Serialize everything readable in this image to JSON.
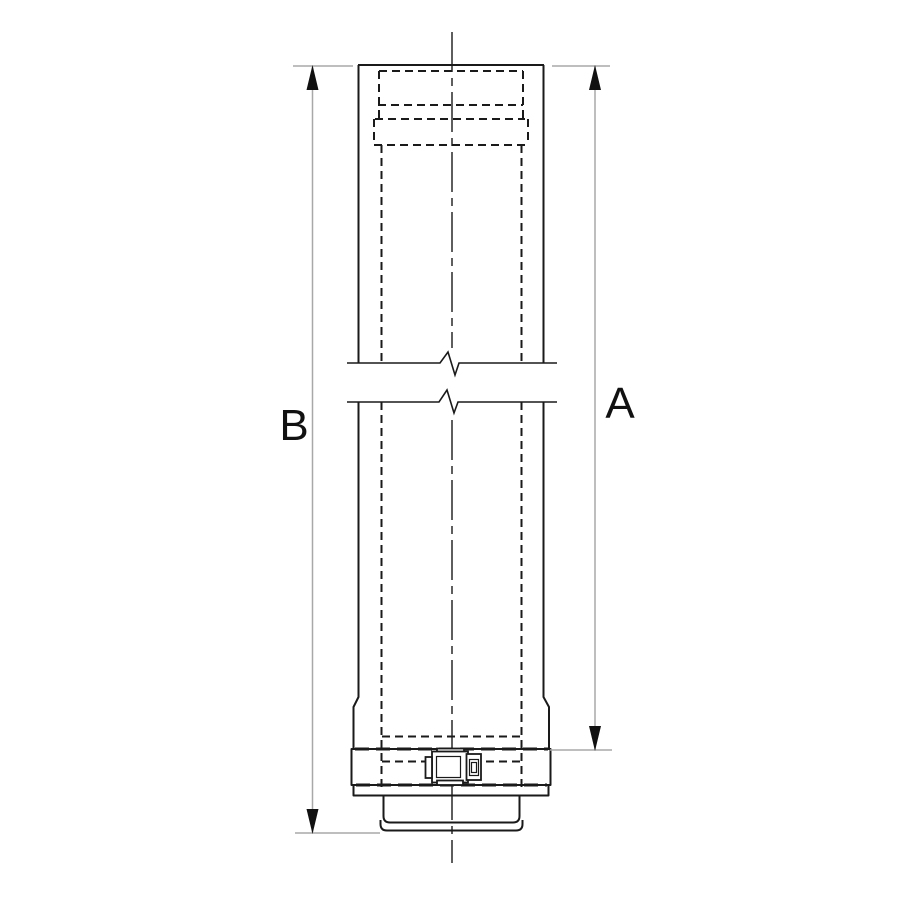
{
  "colors": {
    "background": "#ffffff",
    "line": "#1a1a1a",
    "hidden_line": "#1a1a1a",
    "center_line": "#1a1a1a",
    "dimension_line": "#a8a8a8",
    "arrow": "#111111",
    "label": "#111111",
    "clamp_fill": "#ffffff"
  },
  "dimensions": {
    "a": {
      "label": "A"
    },
    "b": {
      "label": "B"
    }
  },
  "icons": {
    "arrow_up": "filled-triangle-up-icon",
    "arrow_down": "filled-triangle-down-icon"
  }
}
